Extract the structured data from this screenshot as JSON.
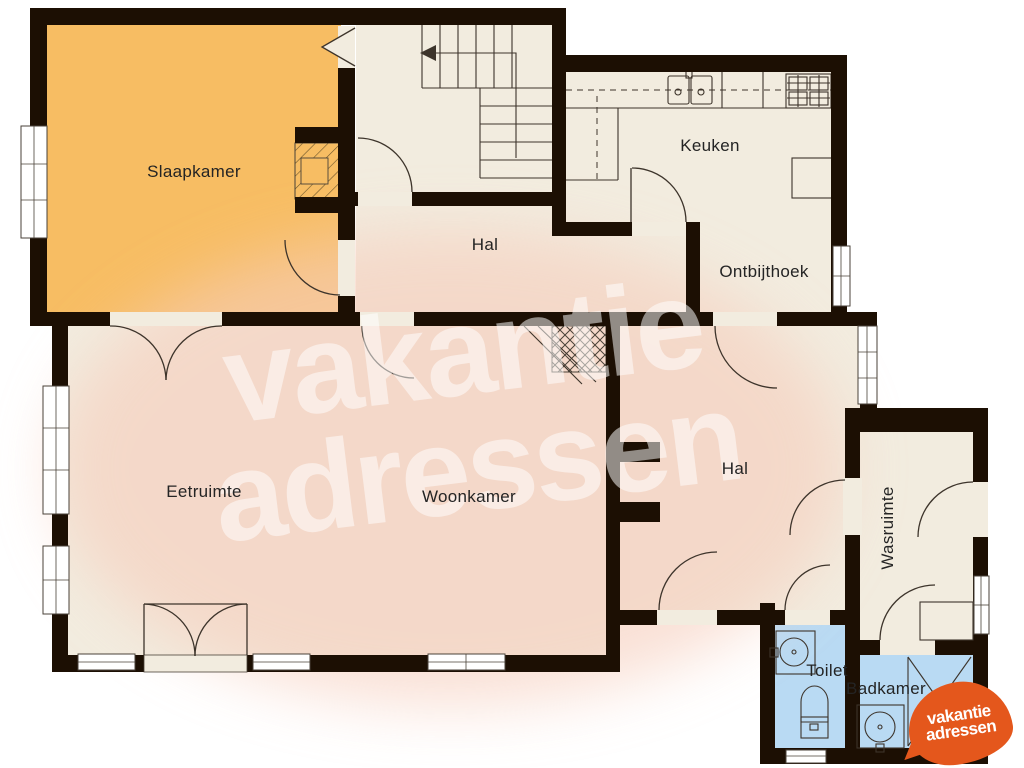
{
  "rooms": {
    "slaapkamer": {
      "label": "Slaapkamer"
    },
    "hal_boven": {
      "label": "Hal"
    },
    "keuken": {
      "label": "Keuken"
    },
    "ontbijthoek": {
      "label": "Ontbijthoek"
    },
    "eetruimte": {
      "label": "Eetruimte"
    },
    "woonkamer": {
      "label": "Woonkamer"
    },
    "hal_onder": {
      "label": "Hal"
    },
    "wasruimte": {
      "label": "Wasruimte"
    },
    "toilet": {
      "label": "Toilet"
    },
    "badkamer": {
      "label": "Badkamer"
    }
  },
  "watermark": {
    "line1": "vakantie",
    "line2": "adressen"
  },
  "logo": {
    "line1": "vakantie",
    "line2": "adressen"
  },
  "colors": {
    "wall": "#1c0f03",
    "floor": "#f2ecdf",
    "bedroom": "#f7bd63",
    "wet": "#b9daf3",
    "blob": "#f6cdbc",
    "logo": "#e4571c",
    "ink": "#3d342b"
  }
}
